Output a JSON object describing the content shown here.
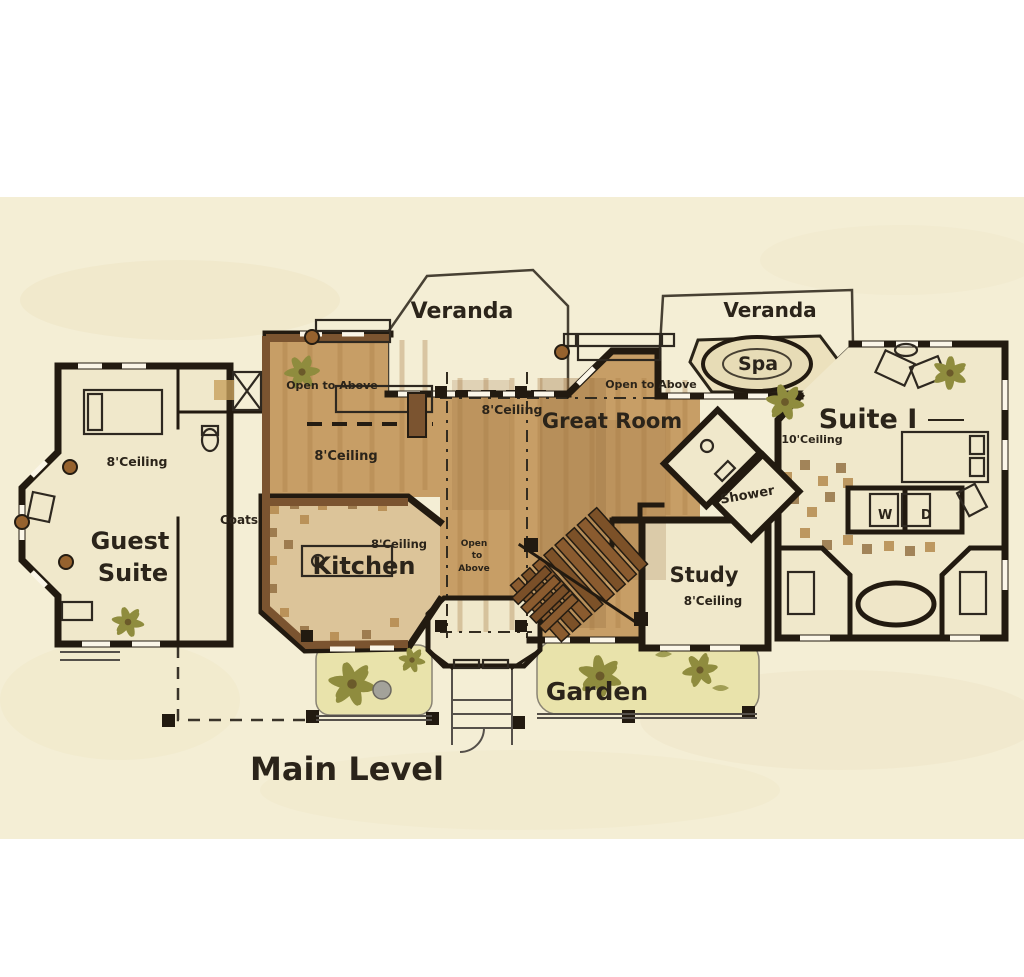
{
  "colors": {
    "paper": "#f4eed5",
    "cream": "#f0e8cb",
    "wood": "#c79e66",
    "woodDark": "#a87c46",
    "tile": "#dcc499",
    "chip": "#b4894e",
    "garden": "#e9e3ab",
    "plant": "#8f8c3e",
    "wall": "#221a10",
    "brown": "#7b5430",
    "stair": "#8a5b2f",
    "ink": "#2b241a"
  },
  "plan": {
    "title": "Main Level",
    "rooms": {
      "veranda_left": {
        "label": "Veranda"
      },
      "veranda_right": {
        "label": "Veranda"
      },
      "spa": {
        "label": "Spa"
      },
      "great_room": {
        "label": "Great Room",
        "ceiling": "8'Ceiling",
        "note": "Open to Above"
      },
      "dining_hall": {
        "ceiling": "8'Ceiling",
        "note": "Open to Above"
      },
      "guest_suite": {
        "label_line1": "Guest",
        "label_line2": "Suite",
        "ceiling": "8'Ceiling"
      },
      "coats": {
        "label": "Coats"
      },
      "kitchen": {
        "label": "Kitchen",
        "ceiling": "8'Ceiling"
      },
      "stairwell": {
        "note_line1": "Open",
        "note_line2": "to",
        "note_line3": "Above"
      },
      "shower": {
        "label": "Shower"
      },
      "laundry": {
        "label": "W D"
      },
      "study": {
        "label": "Study",
        "ceiling": "8'Ceiling"
      },
      "garden": {
        "label": "Garden"
      },
      "suite_one": {
        "label": "Suite I",
        "ceiling": "10'Ceiling"
      }
    }
  }
}
